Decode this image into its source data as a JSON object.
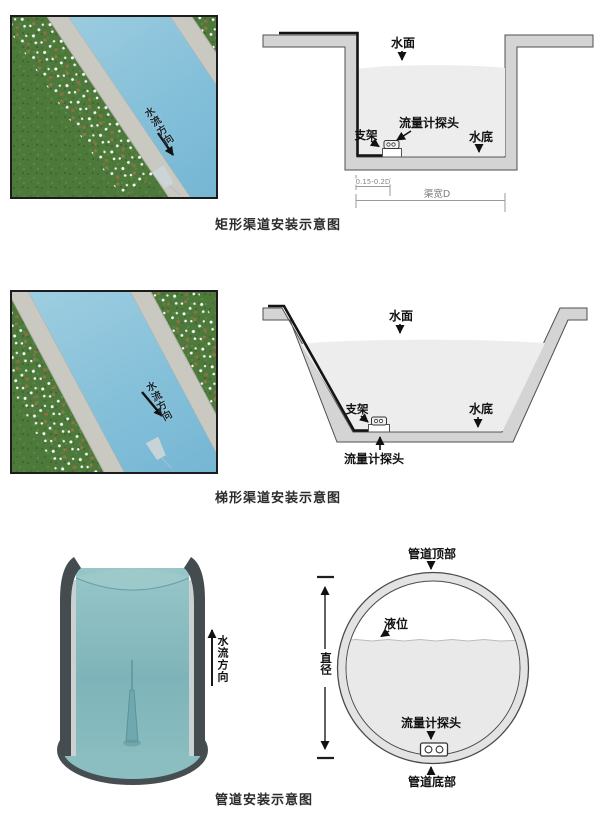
{
  "rect_section": {
    "photo_flow_label": "水流方向",
    "caption": "矩形渠道安装示意图",
    "labels": {
      "water_surface": "水面",
      "probe": "流量计探头",
      "bracket": "支架",
      "channel_bottom": "水底",
      "probe_offset_dim": "0.15-0.2D",
      "channel_width_dim": "渠宽D"
    }
  },
  "trap_section": {
    "photo_flow_label": "水流方向",
    "caption": "梯形渠道安装示意图",
    "labels": {
      "water_surface": "水面",
      "probe": "流量计探头",
      "bracket": "支架",
      "channel_bottom": "水底"
    }
  },
  "pipe_section": {
    "flow_label": "水流方向",
    "caption": "管道安装示意图",
    "labels": {
      "pipe_top": "管道顶部",
      "liquid_level": "液位",
      "diameter": "直径",
      "probe": "流量计探头",
      "pipe_bottom": "管道底部"
    }
  },
  "colors": {
    "wall_gray": "#d4d4d4",
    "water_gray": "#ededed",
    "liner_black": "#141414",
    "river_blue": "#7fbcd9",
    "grass_green": "#4d7a3b",
    "concrete": "#c9c9c1",
    "pipe_teal": "#85b9bd"
  }
}
